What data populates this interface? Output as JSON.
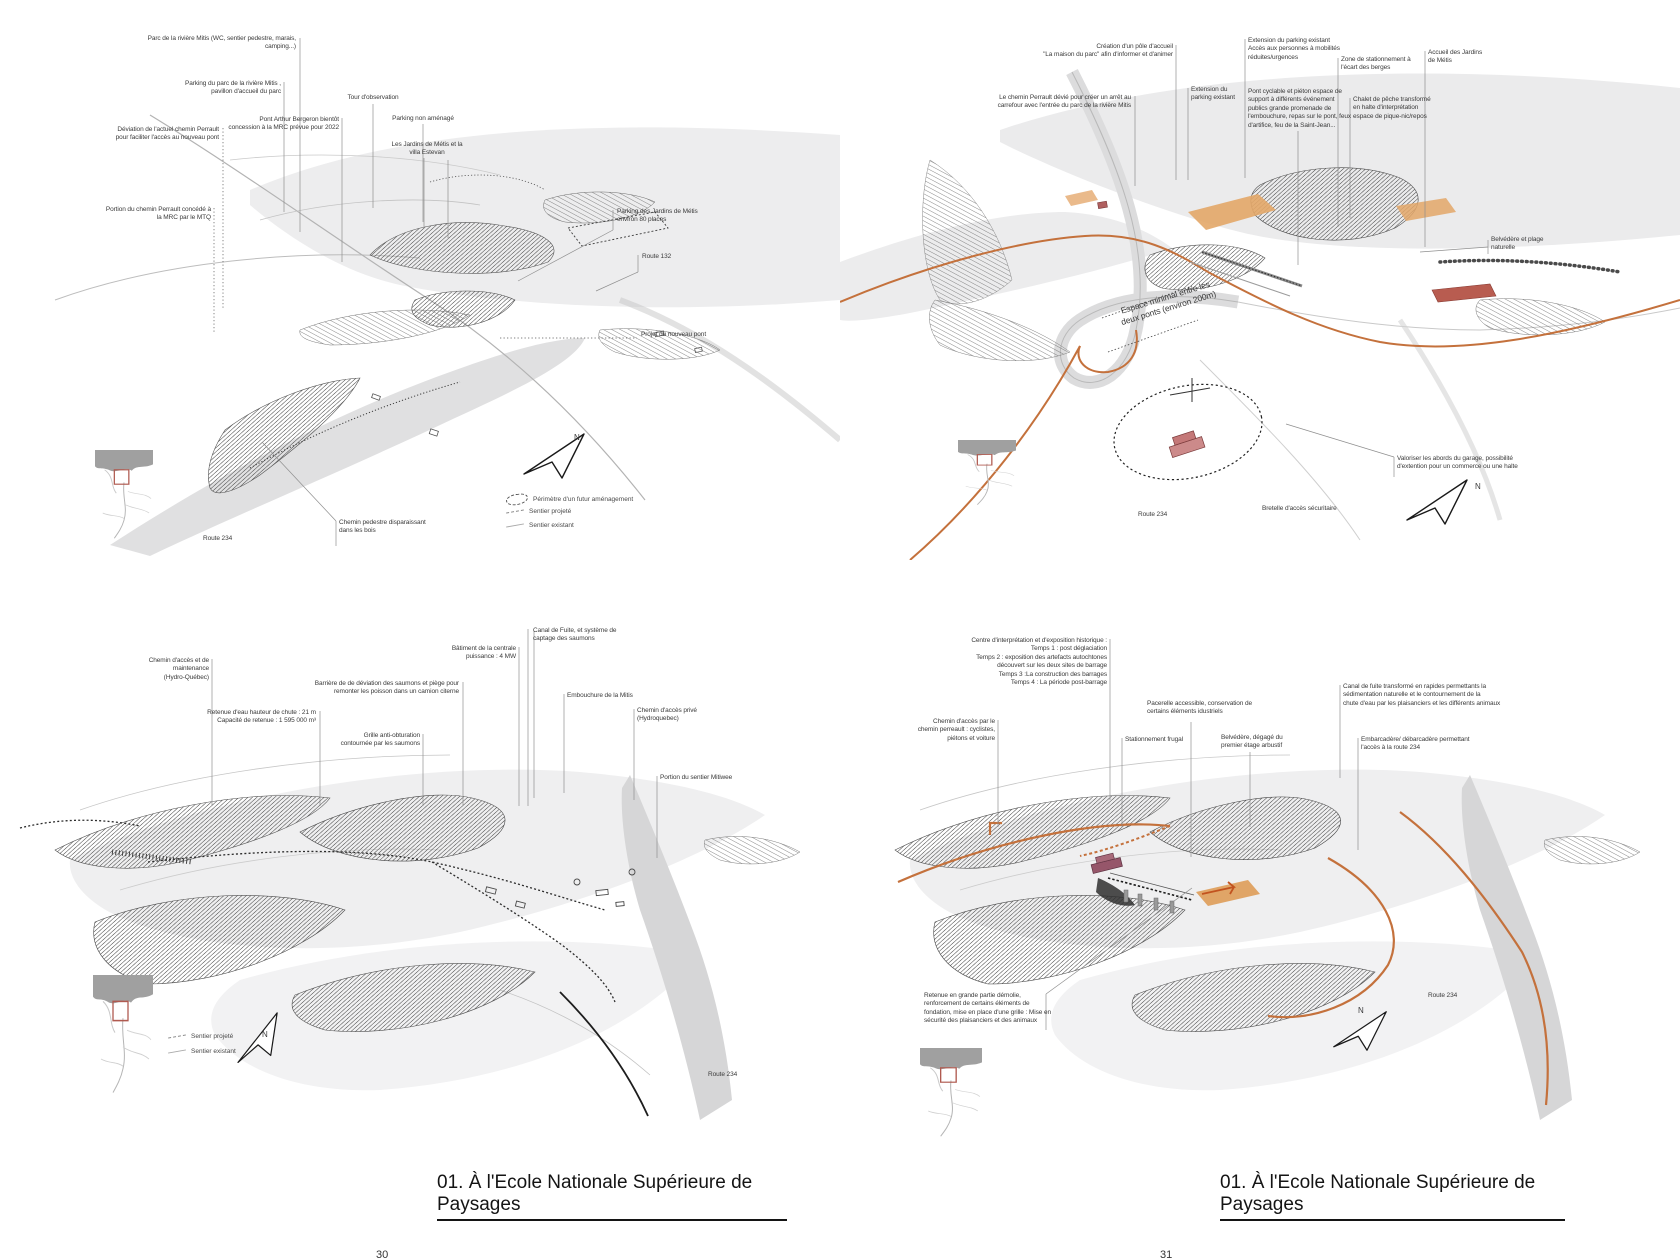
{
  "page": {
    "captions": {
      "left": "01. À l'Ecole Nationale Supérieure de Paysages",
      "right": "01. À l'Ecole Nationale Supérieure de Paysages"
    },
    "page_numbers": {
      "left": "30",
      "right": "31"
    }
  },
  "colors": {
    "accent_orange": "#c4713c",
    "parking_orange_fill": "#e3a768",
    "building_red": "#b85c50",
    "building_pink": "#cc8a8a",
    "building_purple": "#96566a",
    "water_gray": "#ebebec",
    "road_gray": "#d6d6d7",
    "locator_sea_gray": "#a0a0a0",
    "locator_frame_red": "#b05a50",
    "label_text": "#3b3b3b"
  },
  "figures": [
    {
      "id": "top-left",
      "labels": [
        {
          "t": "Parc de la rivière Mitis (WC, sentier pedestre, marais,\ncamping...)",
          "x": 121,
          "y": 35,
          "w": 175,
          "a": "right",
          "leaders": [
            [
              300,
              38,
              300,
              232
            ]
          ]
        },
        {
          "t": "Parking du parc de la rivière Mitis ,\npavillon d'accueil du parc",
          "x": 151,
          "y": 80,
          "w": 130,
          "a": "right",
          "leaders": [
            [
              284,
              82,
              284,
              212
            ]
          ]
        },
        {
          "t": "Tour d'observation",
          "x": 333,
          "y": 94,
          "w": 80,
          "a": "center",
          "leaders": [
            [
              373,
              104,
              373,
              208
            ]
          ]
        },
        {
          "t": "Pont Arthur Bergeron bientôt\nconcession à la MRC prévue pour 2022",
          "x": 199,
          "y": 116,
          "w": 140,
          "a": "right",
          "leaders": [
            [
              342,
              118,
              342,
              262
            ]
          ]
        },
        {
          "t": "Parking non aménagé",
          "x": 383,
          "y": 115,
          "w": 80,
          "a": "center",
          "leaders": [
            [
              423,
              124,
              423,
              222
            ]
          ]
        },
        {
          "t": "Déviation de l'actuel chemin Perrault\npour faciliter l'accès au nouveau pont",
          "x": 79,
          "y": 126,
          "w": 140,
          "a": "right",
          "ldot": true,
          "leaders": [
            [
              223,
              128,
              223,
              310
            ]
          ]
        },
        {
          "t": "Portion du chemin Perrault concédé à\nla MRC par le MTQ",
          "x": 71,
          "y": 206,
          "w": 140,
          "a": "right",
          "ldot": true,
          "leaders": [
            [
              214,
              208,
              214,
              332
            ]
          ]
        },
        {
          "t": "Les Jardins de Métis et la\nvilla Estevan",
          "x": 387,
          "y": 141,
          "w": 80,
          "a": "center",
          "leaders": [
            [
              424,
              158,
              424,
              228
            ],
            [
              448,
              160,
              448,
              238
            ]
          ]
        },
        {
          "t": "Parking des Jardins de Métis\nenviron 80 places",
          "x": 617,
          "y": 208,
          "w": 115,
          "a": "left",
          "leaders": [
            [
              613,
              210,
              613,
              230
            ],
            [
              613,
              230,
              518,
              281
            ]
          ]
        },
        {
          "t": "Route 132",
          "x": 642,
          "y": 253,
          "w": 50,
          "a": "left",
          "leaders": [
            [
              638,
              255,
              638,
              272
            ],
            [
              638,
              272,
              596,
              291
            ]
          ]
        },
        {
          "t": "Projet du nouveau pont",
          "x": 641,
          "y": 331,
          "w": 90,
          "a": "left",
          "ldot": true,
          "leaders": [
            [
              500,
              338,
              637,
              338
            ]
          ]
        },
        {
          "t": "Chemin pedestre disparaissant\ndans les bois",
          "x": 339,
          "y": 519,
          "w": 110,
          "a": "left",
          "leaders": [
            [
              336,
              521,
              336,
              546
            ],
            [
              336,
              521,
              262,
              442
            ]
          ]
        },
        {
          "t": "Route 234",
          "x": 203,
          "y": 535,
          "w": 44,
          "a": "left",
          "name": "route-label"
        },
        {
          "t": "N",
          "x": 574,
          "y": 433,
          "w": 12,
          "fs": 8,
          "name": "north-letter"
        }
      ],
      "legend": {
        "x": 506,
        "y": 494,
        "row": 14,
        "items": [
          {
            "icon": "perimeter",
            "t": "Périmètre d'un futur aménagement"
          },
          {
            "icon": "dash",
            "t": "Sentier projeté"
          },
          {
            "icon": "solid",
            "t": "Sentier existant"
          }
        ]
      }
    },
    {
      "id": "top-right",
      "labels": [
        {
          "t": "Le chemin Perrault dévié pour créer  un arrêt au\ncarrefour avec l'entrée du parc de la rivière Mitis",
          "x": 971,
          "y": 94,
          "w": 160,
          "a": "right",
          "leaders": [
            [
              1135,
              96,
              1135,
              186
            ]
          ]
        },
        {
          "t": "Création d'un pôle d'accueil\n\"La maison du parc\" afin d'informer et d'animer",
          "x": 1023,
          "y": 43,
          "w": 150,
          "a": "right",
          "leaders": [
            [
              1176,
              45,
              1176,
              180
            ]
          ]
        },
        {
          "t": "Extension du\nparking existant",
          "x": 1191,
          "y": 86,
          "w": 55,
          "a": "left",
          "leaders": [
            [
              1188,
              88,
              1188,
              180
            ]
          ]
        },
        {
          "t": "Extension du parking existant\nAccès aux personnes à mobilités\nréduites/urgences",
          "x": 1248,
          "y": 37,
          "w": 110,
          "a": "left",
          "leaders": [
            [
              1245,
              39,
              1245,
              178
            ]
          ]
        },
        {
          "t": "Pont cyclable et piéton espace de\nsupport à différents événement\npublics grande promenade de\nl'embouchure, repas sur le pont, feux\nd'artifice, feu de la Saint-Jean...",
          "x": 1248,
          "y": 88,
          "w": 115,
          "a": "left",
          "leaders": [
            [
              1298,
              131,
              1298,
              265
            ]
          ]
        },
        {
          "t": "Zone de stationnement à\nl'écart des berges",
          "x": 1341,
          "y": 56,
          "w": 90,
          "a": "left",
          "leaders": [
            [
              1338,
              58,
              1338,
              227
            ]
          ]
        },
        {
          "t": "Chalet de pêche transformé\nen halte d'interprétation\nespace de pique-nic/repos",
          "x": 1353,
          "y": 96,
          "w": 95,
          "a": "left",
          "leaders": [
            [
              1350,
              98,
              1350,
              218
            ]
          ]
        },
        {
          "t": "Accueil des Jardins\nde Métis",
          "x": 1428,
          "y": 49,
          "w": 75,
          "a": "left",
          "leaders": [
            [
              1425,
              51,
              1425,
              247
            ]
          ]
        },
        {
          "t": "Belvédère et plage\nnaturelle",
          "x": 1491,
          "y": 236,
          "w": 70,
          "a": "left",
          "leaders": [
            [
              1488,
              240,
              1488,
              254
            ],
            [
              1488,
              247,
              1420,
              252
            ]
          ]
        },
        {
          "t": "Espace minimal entre les\ndeux ponts (environ 200m)",
          "x": 1112,
          "y": 292,
          "w": 110,
          "a": "center",
          "rot": -17,
          "fs": 8.5,
          "name": "map-note"
        },
        {
          "t": "Valoriser les abords du garage, possibilité\nd'extention pour un commerce ou une halte",
          "x": 1397,
          "y": 455,
          "w": 140,
          "a": "left",
          "leaders": [
            [
              1394,
              457,
              1394,
              477
            ],
            [
              1394,
              457,
              1286,
              424
            ]
          ]
        },
        {
          "t": "Bretelle d'accès sécuritaire",
          "x": 1262,
          "y": 505,
          "w": 95,
          "a": "left"
        },
        {
          "t": "Route 234",
          "x": 1138,
          "y": 511,
          "w": 44,
          "a": "left",
          "name": "route-label"
        },
        {
          "t": "N",
          "x": 1475,
          "y": 482,
          "w": 12,
          "fs": 8,
          "name": "north-letter"
        }
      ]
    },
    {
      "id": "bottom-left",
      "labels": [
        {
          "t": "Chemin d'accès et de\nmaintenance\n(Hydro-Québec)",
          "x": 119,
          "y": 657,
          "w": 90,
          "a": "right",
          "leaders": [
            [
              212,
              659,
              212,
              806
            ]
          ]
        },
        {
          "t": "Retenue d'eau hauteur de chute : 21 m\nCapacité de retenue : 1 595 000 m³",
          "x": 176,
          "y": 709,
          "w": 140,
          "a": "right",
          "leaders": [
            [
              320,
              711,
              320,
              806
            ]
          ]
        },
        {
          "t": "Barrière de de déviation des saumons et piège pour\nremonter les poisson dans un camion citerne",
          "x": 299,
          "y": 680,
          "w": 160,
          "a": "right",
          "leaders": [
            [
              463,
              682,
              463,
              806
            ]
          ]
        },
        {
          "t": "Grille anti-obturation\ncontournée par les saumons",
          "x": 310,
          "y": 732,
          "w": 110,
          "a": "right",
          "leaders": [
            [
              423,
              734,
              423,
              806
            ]
          ]
        },
        {
          "t": "Bâtiment de la centrale\npuissance : 4 MW",
          "x": 416,
          "y": 645,
          "w": 100,
          "a": "right",
          "leaders": [
            [
              519,
              647,
              519,
              806
            ]
          ]
        },
        {
          "t": "Canal de Fuite, et système de\ncaptage des saumons",
          "x": 533,
          "y": 627,
          "w": 105,
          "a": "left",
          "leaders": [
            [
              528,
              629,
              528,
              806
            ],
            [
              534,
              631,
              534,
              798
            ]
          ]
        },
        {
          "t": "Embouchure de la Mitis",
          "x": 567,
          "y": 692,
          "w": 88,
          "a": "left",
          "leaders": [
            [
              564,
              694,
              564,
              793
            ]
          ]
        },
        {
          "t": "Chemin d'accès privé\n(Hydroquebec)",
          "x": 637,
          "y": 707,
          "w": 78,
          "a": "left",
          "leaders": [
            [
              634,
              709,
              634,
              800
            ]
          ]
        },
        {
          "t": "Portion du sentier Mitiwee",
          "x": 660,
          "y": 774,
          "w": 90,
          "a": "left",
          "leaders": [
            [
              657,
              776,
              657,
              858
            ]
          ]
        },
        {
          "t": "Route 234",
          "x": 708,
          "y": 1071,
          "w": 44,
          "a": "left",
          "name": "route-label"
        },
        {
          "t": "N",
          "x": 262,
          "y": 1030,
          "w": 12,
          "fs": 8,
          "name": "north-letter"
        }
      ],
      "legend": {
        "x": 168,
        "y": 1033,
        "row": 15,
        "items": [
          {
            "icon": "dash",
            "t": "Sentier projeté"
          },
          {
            "icon": "solid",
            "t": "Sentier existant"
          }
        ]
      }
    },
    {
      "id": "bottom-right",
      "labels": [
        {
          "t": "Centre d'interprétation et d'exposition historique :\nTemps 1 : post déglaciation\nTemps 2 : exposition des artefacts autochtones\ndécouvert sur les deux sites de barrage\nTemps 3 :La construction des barrages\nTemps 4 : La période post-barrage",
          "x": 947,
          "y": 637,
          "w": 160,
          "a": "right",
          "leaders": [
            [
              1110,
              639,
              1110,
              800
            ]
          ]
        },
        {
          "t": "Pacerelle accessible, conservation de\ncertains éléments idustriels",
          "x": 1147,
          "y": 700,
          "w": 115,
          "a": "left",
          "leaders": [
            [
              1191,
              722,
              1191,
              857
            ]
          ]
        },
        {
          "t": "Canal de fuite transformé en rapides permettants la\nsédimentation naturelle et le contournement de la\nchute d'eau par les plaisanciers et les différents animaux",
          "x": 1343,
          "y": 683,
          "w": 165,
          "a": "left",
          "leaders": [
            [
              1340,
              685,
              1340,
              778
            ]
          ]
        },
        {
          "t": "Chemin d'accès par le\nchemin perreault  : cyclistes,\npiétons et voiture",
          "x": 895,
          "y": 718,
          "w": 100,
          "a": "right",
          "leaders": [
            [
              998,
              720,
              998,
              827
            ]
          ]
        },
        {
          "t": "Stationnement frugal",
          "x": 1125,
          "y": 736,
          "w": 70,
          "a": "left",
          "leaders": [
            [
              1122,
              738,
              1122,
              827
            ]
          ]
        },
        {
          "t": "Belvédère, dégagé du\npremier étage arbustif",
          "x": 1221,
          "y": 734,
          "w": 80,
          "a": "left",
          "leaders": [
            [
              1250,
              752,
              1250,
              827
            ]
          ]
        },
        {
          "t": "Embarcadère/ débarcadère permettant\nl'accès à la route 234",
          "x": 1361,
          "y": 736,
          "w": 130,
          "a": "left",
          "leaders": [
            [
              1358,
              738,
              1358,
              850
            ]
          ]
        },
        {
          "t": "Retenue en grande partie démolie,\nrenforcement de certains éléments de\nfondation, mise en place d'une grille : Mise en\nsécurité des plaisanciers et des animaux",
          "x": 924,
          "y": 992,
          "w": 150,
          "a": "left",
          "leaders": [
            [
              1046,
              994,
              1046,
              1030
            ],
            [
              1046,
              994,
              1192,
              888
            ]
          ]
        },
        {
          "t": "Route 234",
          "x": 1428,
          "y": 992,
          "w": 44,
          "a": "left",
          "name": "route-label"
        },
        {
          "t": "N",
          "x": 1358,
          "y": 1006,
          "w": 12,
          "fs": 8,
          "name": "north-letter"
        }
      ]
    }
  ]
}
